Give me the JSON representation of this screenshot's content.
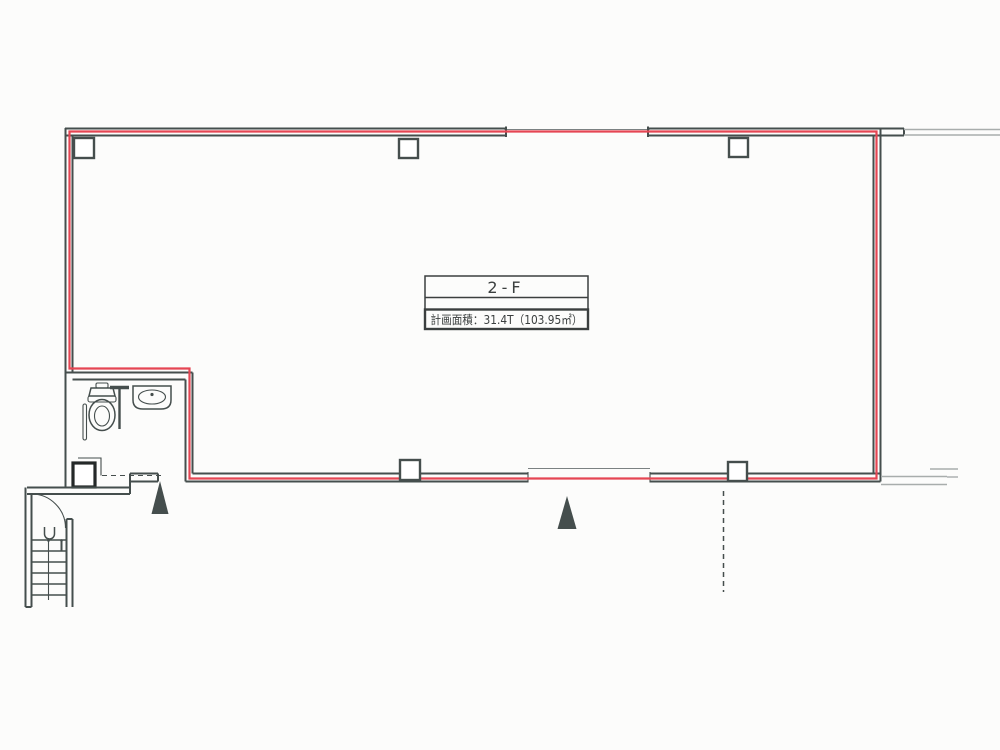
{
  "plan": {
    "floor_label": "2-F",
    "area_label": "計画面積：31.4T（103.95㎡）"
  },
  "colors": {
    "lease_boundary_red": "#e54653",
    "wall_dark": "#454e4d",
    "wall_light": "#a8adac",
    "paper": "#fcfcfb",
    "text": "#3b3f3f"
  },
  "symbols": {
    "column_marker": "small-square-outline",
    "column_count": 6,
    "entrance_marker": "filled-triangle-arrow-up",
    "entrance_marker_count": 2,
    "fixtures": [
      "toilet",
      "vanity-sink",
      "partition",
      "grab-bar",
      "staircase",
      "door-swing"
    ]
  }
}
